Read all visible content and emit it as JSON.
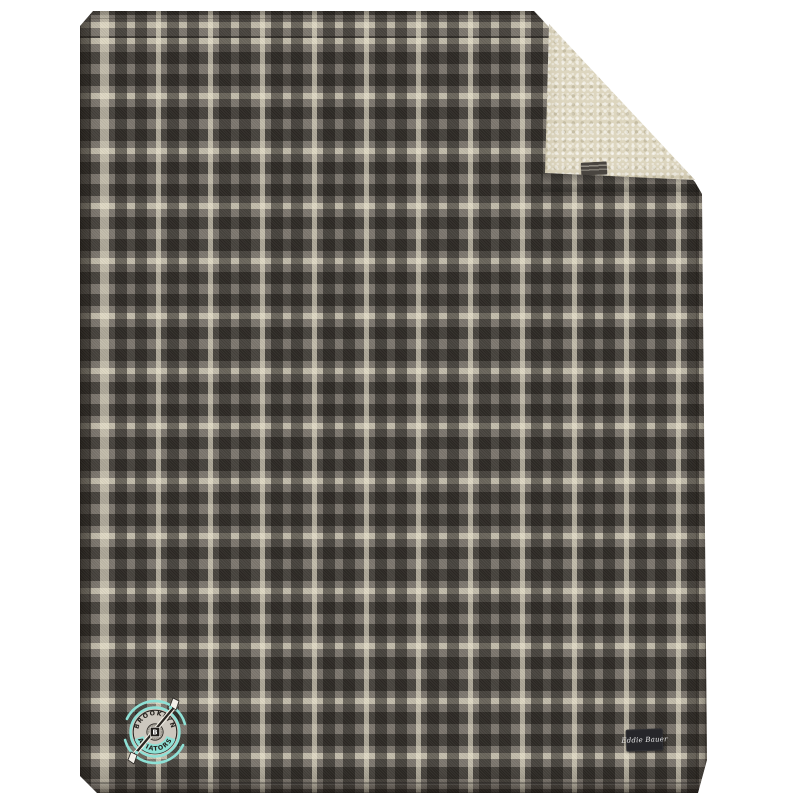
{
  "scene": {
    "type": "product photo",
    "background_color": "#ffffff",
    "product_name": "gray plaid fleece blanket with cream sherpa reverse, top-right corner folded over"
  },
  "blanket": {
    "plaid": {
      "base_color": "#7d776f",
      "dark_stripe_color": "#332f2a",
      "cream_stripe_color": "#e9e2cb",
      "vertical_period_px": 52,
      "horizontal_period_px": 55
    },
    "sherpa": {
      "color": "#ddd6bf"
    },
    "care_tag": {
      "bg_color": "#494540"
    },
    "brand_label": {
      "text": "Eddie Bauer",
      "bg_color": "#26262a",
      "text_color": "#e9e9e9"
    }
  },
  "logo": {
    "top_text": "BROOKLYN",
    "bottom_text": "AVIATORS",
    "monogram": "B",
    "accent_color": "#8ee0d5",
    "badge_bg_color": "#ccc7be",
    "text_color": "#26231f"
  }
}
